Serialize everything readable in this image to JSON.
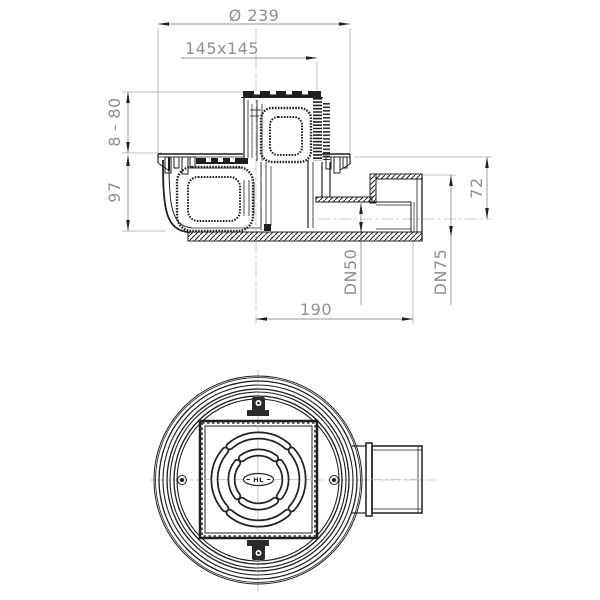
{
  "drawing": {
    "kind": "floor drain technical drawing",
    "section_view": {
      "dimensions": {
        "outer_diameter": "Ø 239",
        "grate_size": "145x145",
        "height_adjust": "8 - 80",
        "body_height": "97",
        "outlet_height": "72",
        "dn50": "DN50",
        "dn75": "DN75",
        "outlet_length": "190"
      }
    },
    "top_view": {
      "logo": "HL"
    },
    "colors": {
      "background": "#ffffff",
      "part_line": "#1f1f1f",
      "dimension_line": "#949494",
      "dimension_text": "#8f8f8f"
    }
  }
}
